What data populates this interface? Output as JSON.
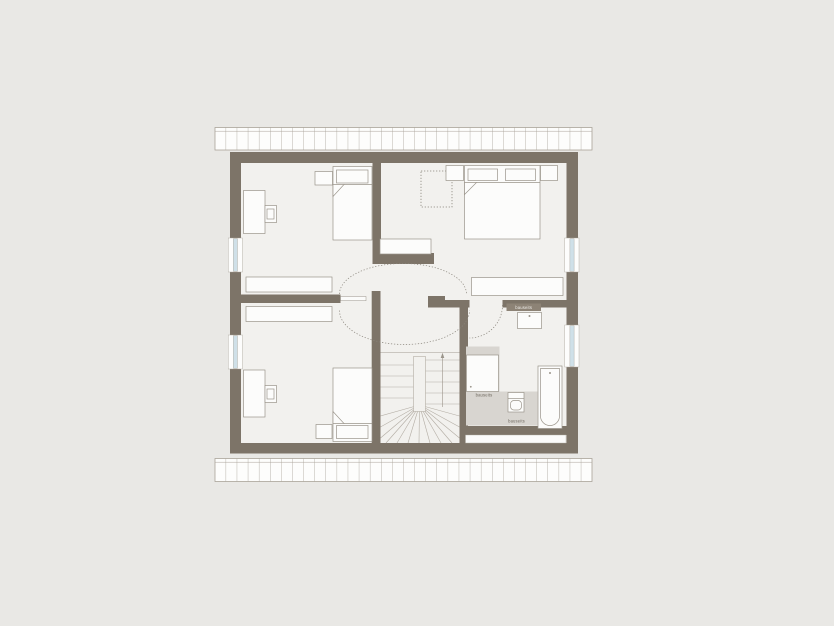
{
  "plan": {
    "type": "attic-floor-plan",
    "labels": {
      "niche": "bauseits",
      "shower": "bauseits",
      "bath_floor": "bauseits"
    },
    "palette": {
      "background": "#e9e8e5",
      "floor": "#f2f1ee",
      "wall": "#7d7468",
      "furniture_fill": "#fcfcfb",
      "furniture_outline": "#9a948a",
      "stair_line": "#b3ada4",
      "window_glass": "#cfe0e8",
      "bath_floor_area": "#d8d5d0",
      "niche_strip": "#8d8376",
      "label_text": "#6f695f",
      "dashed_line": "#8a857c",
      "roof_hatch_line": "#a9a399"
    }
  }
}
